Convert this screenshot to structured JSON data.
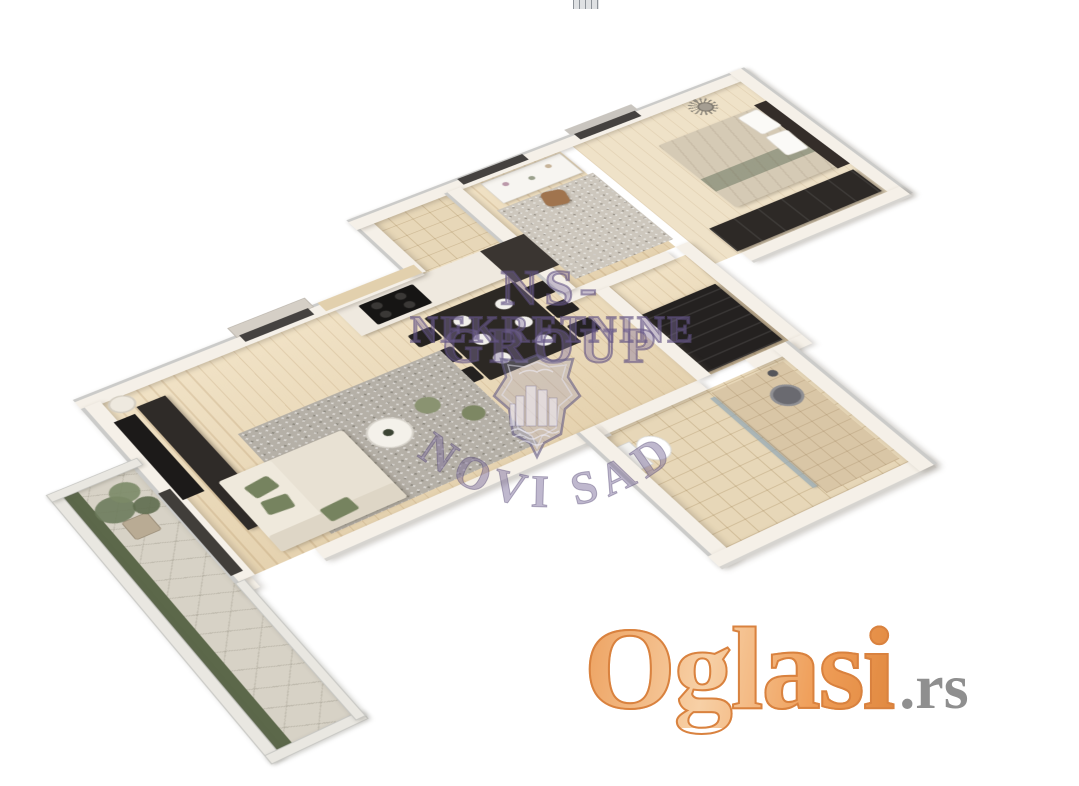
{
  "watermark": {
    "line1": "NS-GROUP",
    "line2": "NEKRETNINE",
    "arc_text": "NOVI SAD",
    "shield_icon": "city-crest-shield-icon",
    "color": "#7a6aa0"
  },
  "logo": {
    "brand": "Oglasi",
    "tld": ".rs",
    "brand_color": "#ec9a58",
    "tld_color": "#8f8f8f"
  },
  "top_strip": {
    "icon": "previous-photo-edge-sliver"
  },
  "floorplan": {
    "style": "3d-rendered top-down apartment plan, rotated diagonally on white background",
    "rooms": [
      {
        "name": "living-room",
        "floor": "wood",
        "furniture": [
          "wall-tv",
          "tv-console",
          "floor-lamp",
          "window-roman-blind",
          "dining-table-with-6-chairs-and-plates",
          "corner-sofa",
          "green-cushions",
          "round-coffee-table",
          "green-poufs",
          "gray-area-rug"
        ]
      },
      {
        "name": "kitchen",
        "floor": "tile",
        "furniture": [
          "counter",
          "black-cooktop",
          "dark-base-cabinet",
          "tiled-backsplash"
        ]
      },
      {
        "name": "office",
        "floor": "wood",
        "furniture": [
          "white-desk",
          "desk-chair",
          "window",
          "gray-rug"
        ]
      },
      {
        "name": "hallway",
        "floor": "wood",
        "furniture": [
          "dark-wardrobe"
        ]
      },
      {
        "name": "bedroom",
        "floor": "wood",
        "furniture": [
          "double-bed",
          "dark-headboard",
          "white-pillows",
          "dark-wardrobe",
          "sunburst-mirror",
          "window-with-curtain"
        ]
      },
      {
        "name": "bathroom",
        "floor": "tile",
        "furniture": [
          "toilet",
          "walk-in-shower",
          "glass-partition",
          "round-mirror",
          "shower-head"
        ]
      },
      {
        "name": "terrace",
        "floor": "stone",
        "furniture": [
          "potted-plant",
          "planting-strip",
          "glass-parapet"
        ]
      }
    ]
  },
  "colors": {
    "background": "#ffffff",
    "wall": "#f5f0e8",
    "wall_edge": "#cbcbc9",
    "wood_floor": "#ead9b9",
    "tile_floor": "#e7d7b8",
    "terrace_stone": "#d7d2c6",
    "dark_furniture": "#2f2b28",
    "sofa": "#e8e1d3",
    "accent_green": "#76835f"
  }
}
